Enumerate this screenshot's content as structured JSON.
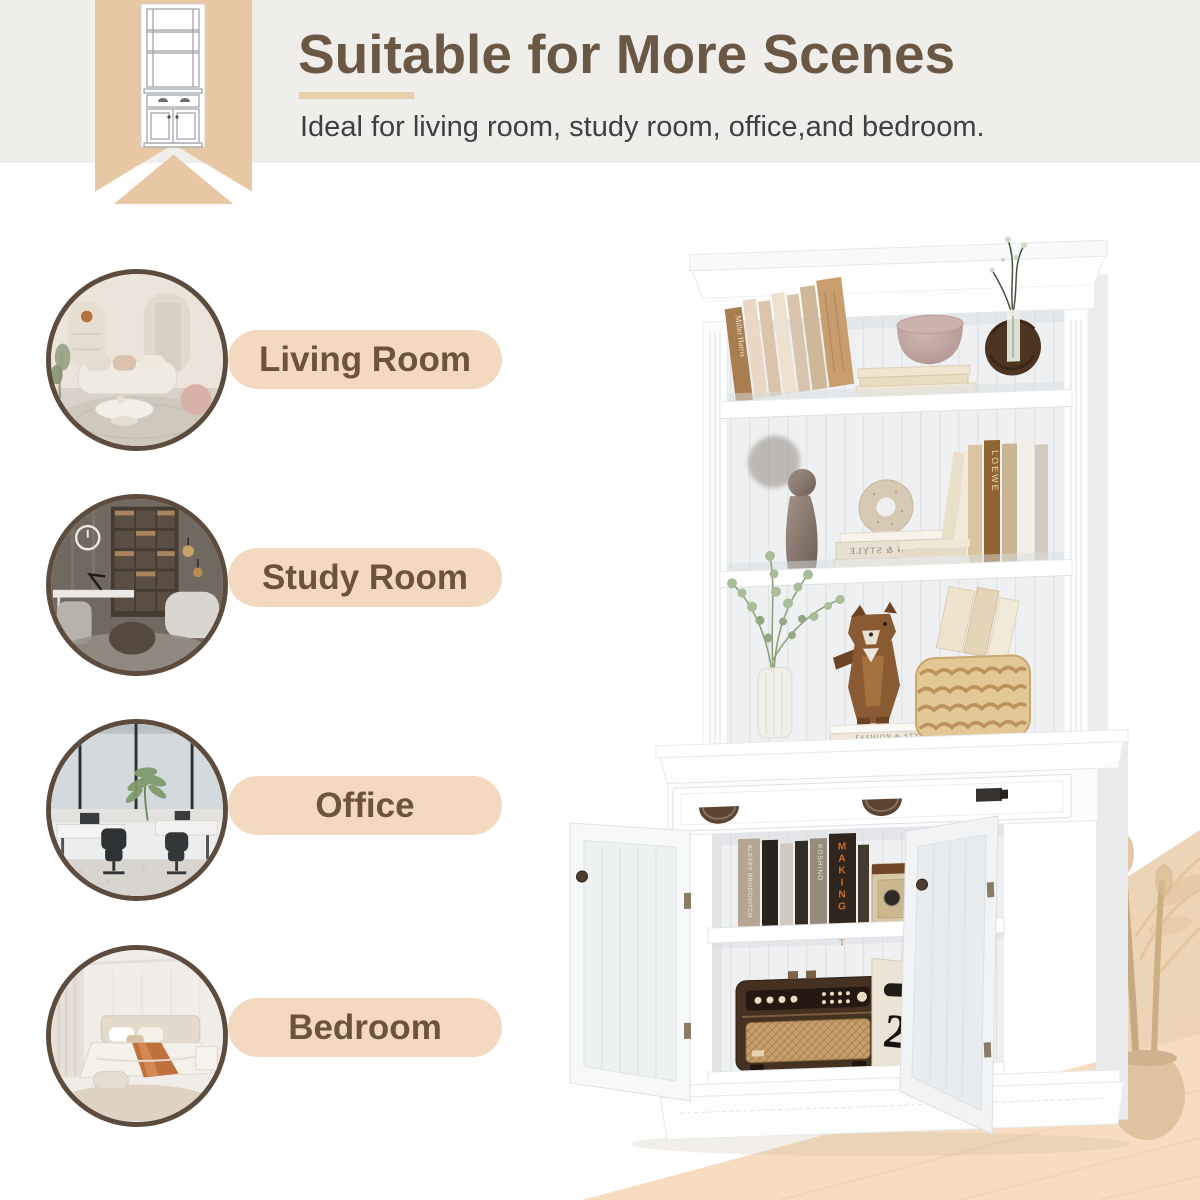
{
  "header": {
    "title": "Suitable for More Scenes",
    "subtitle": "Ideal for living room, study room, office,and bedroom.",
    "title_color": "#6b5844",
    "underline_color": "#e6cfab",
    "band_color": "#f0eeeb"
  },
  "ribbon": {
    "color": "#e8c7a5",
    "icon": "bookcase-line-drawing"
  },
  "scenes": [
    {
      "label": "Living Room"
    },
    {
      "label": "Study Room"
    },
    {
      "label": "Office"
    },
    {
      "label": "Bedroom"
    }
  ],
  "scene_style": {
    "pill_bg": "#f2d9c0",
    "pill_text_color": "#6b5340",
    "circle_border_color": "#5d4c3e"
  },
  "product": {
    "description": "White bookshelf hutch with drawer and open double-door cabinet, styled with books and decor",
    "texts": {
      "miller_harris": "Miller Harris",
      "fashion_style": "FASHION & STYLE",
      "making_it": "MAKING IT",
      "spine_alexey": "ALEXEY BRODOVITCH",
      "spine_koshino": "KOSHINO",
      "spine_loewe": "LOEWE",
      "box_number": "2"
    }
  }
}
